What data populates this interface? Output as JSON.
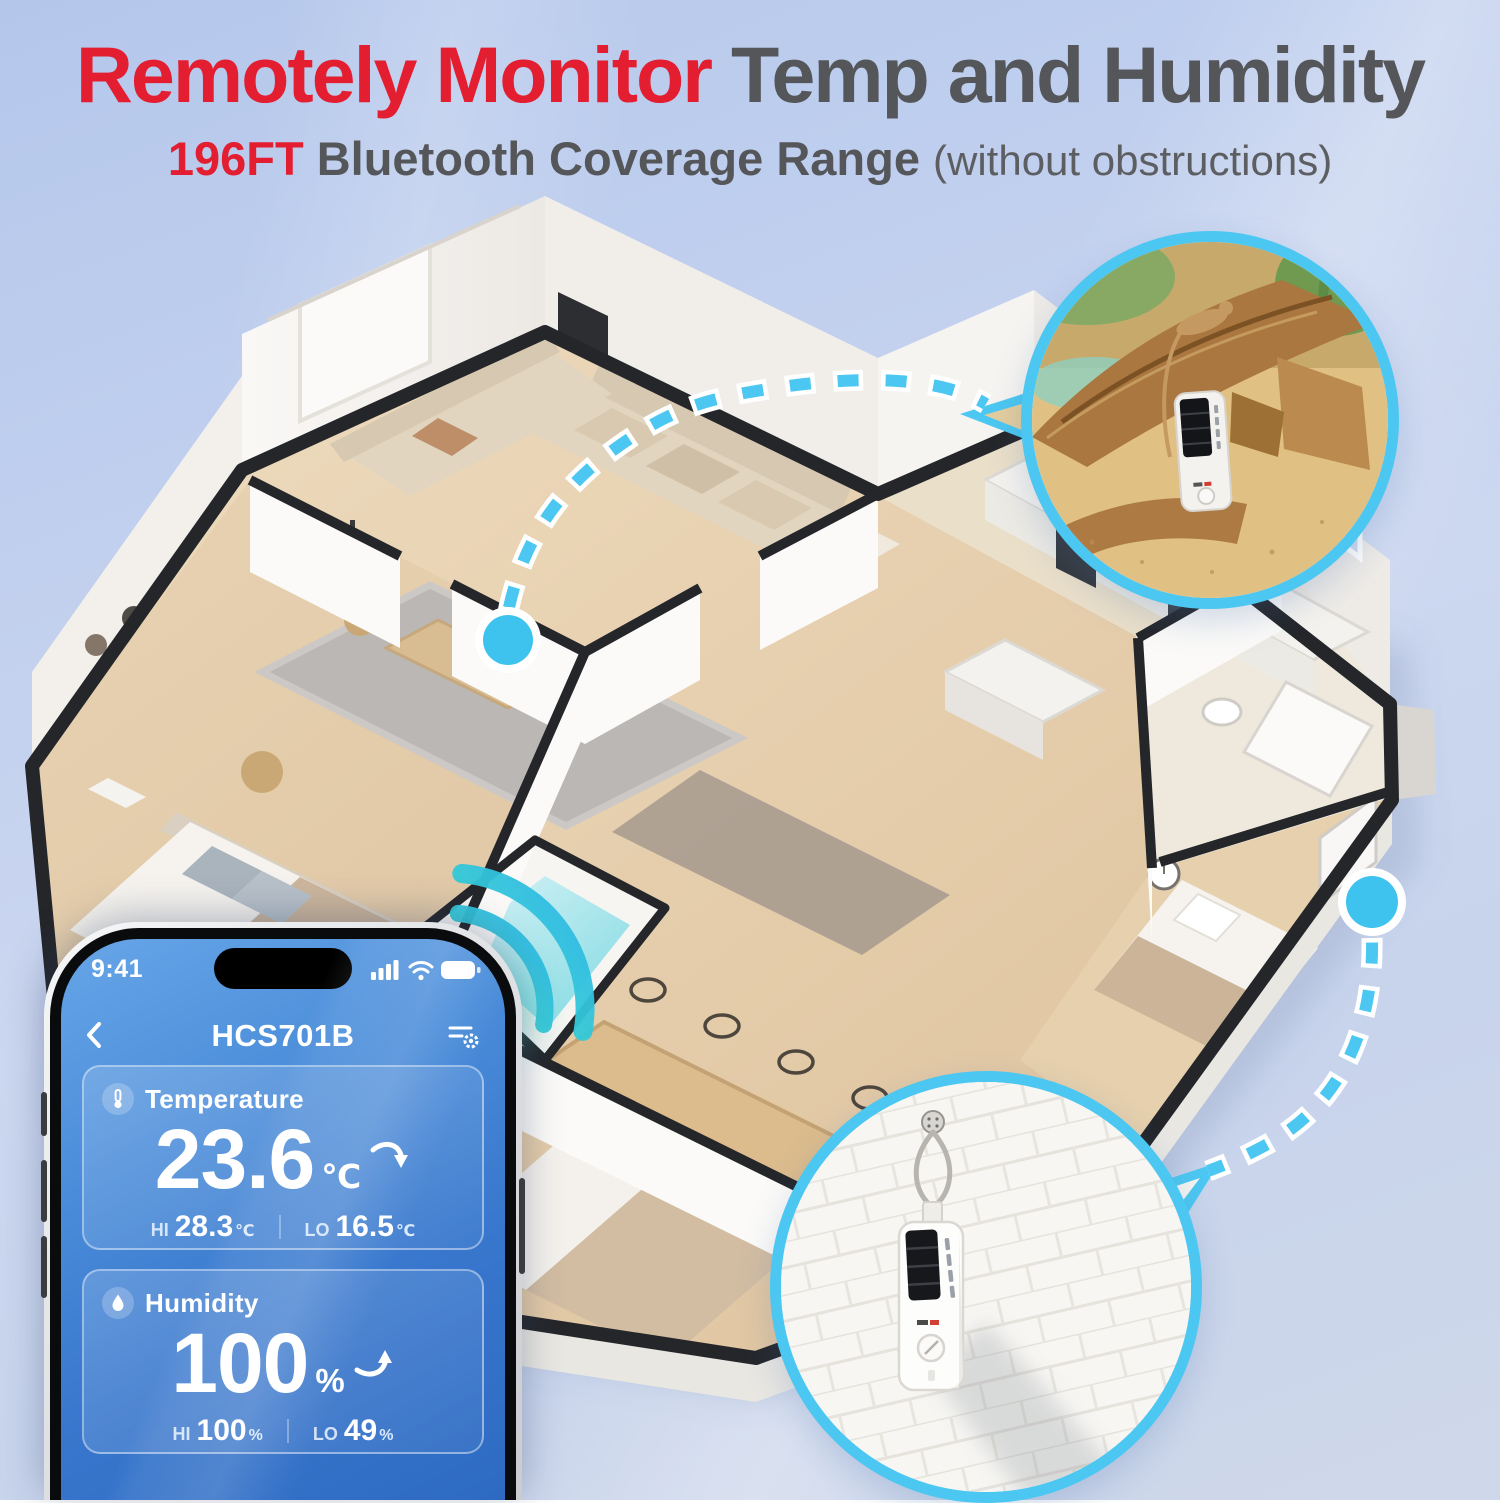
{
  "headline": {
    "lead": "Remotely Monitor",
    "rest": " Temp and Humidity"
  },
  "subheadline": {
    "range": "196FT",
    "text": " Bluetooth Coverage Range ",
    "note": "(without obstructions)"
  },
  "phone": {
    "status": {
      "time": "9:41"
    },
    "nav": {
      "title": "HCS701B"
    },
    "temperature": {
      "label": "Temperature",
      "value": "23.6",
      "unit": "℃",
      "trend": "down",
      "hi_label": "HI",
      "hi_value": "28.3",
      "hi_unit": "℃",
      "lo_label": "LO",
      "lo_value": "16.5",
      "lo_unit": "℃"
    },
    "humidity": {
      "label": "Humidity",
      "value": "100",
      "unit": "%",
      "trend": "up",
      "hi_label": "HI",
      "hi_value": "100",
      "hi_unit": "%",
      "lo_label": "LO",
      "lo_value": "49",
      "lo_unit": "%"
    }
  },
  "callouts": {
    "terrarium": "sensor standing in reptile terrarium",
    "wall": "sensor hanging on white brick wall"
  },
  "connections": {
    "sensor_dots": 2,
    "line_style": "dashed"
  },
  "colors": {
    "accent_cyan": "#4CC7F1",
    "dot_cyan": "#3EC2EE",
    "headline_red": "#E41E31",
    "headline_gray": "#55565A",
    "screen_blue_top": "#66A5E7",
    "screen_blue_bottom": "#2E6AC2",
    "wall_cap": "#24262A",
    "floor_wood": "#E8D5B7"
  },
  "icons": {
    "back": "chevron-left-icon",
    "settings": "filter-gear-icon",
    "temperature": "thermometer-icon",
    "humidity": "droplet-icon",
    "signal": "cellular-bars-icon",
    "wifi": "wifi-icon",
    "battery": "battery-full-icon",
    "trend_down": "curved-arrow-down-icon",
    "trend_up": "curved-arrow-up-icon",
    "bluetooth_wave": "signal-waves-icon"
  }
}
